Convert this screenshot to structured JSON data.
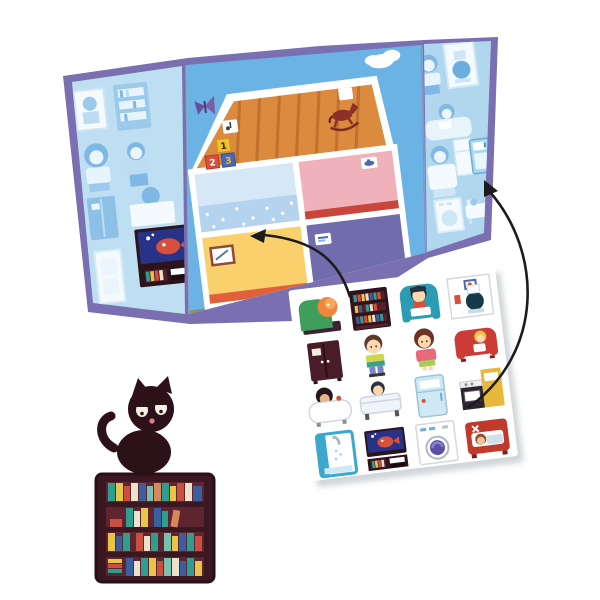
{
  "scene": {
    "description": "Product photo of a toy sticker play-set: open tri-fold house board, sticker sheet, loose cat and bookshelf stickers, two placement arrows",
    "background_color": "#ffffff"
  },
  "colors": {
    "board_border": "#7a6fb0",
    "left_flap_bg": "#bedef2",
    "center_bg": "#6cb3e5",
    "right_flap_bg": "#b0d7ee",
    "attic_floor": "#dc8a3e",
    "room_bathroom": "#d6e8f6",
    "room_bedroom_pink": "#f0b2ba",
    "room_living_yellow": "#f9d06b",
    "room_play_purple": "#716cab",
    "ground": "#8d9464",
    "sheet_bg": "#ffffff",
    "arrow": "#1c1c1c",
    "cat": "#2d1118",
    "bookshelf": "#3b1722"
  },
  "board": {
    "left_flap": {
      "silhouette_items": [
        "framed picture",
        "bookshelf",
        "girl",
        "boy",
        "wardrobe",
        "child at desk",
        "door"
      ],
      "placed_sticker": "tv-stand-with-fish-tank"
    },
    "center_panel": {
      "sky_items": [
        "cloud",
        "butterfly"
      ],
      "house": {
        "attic": {
          "items": [
            "sticker slot",
            "toy blocks",
            "rocking horse",
            "wall slot"
          ],
          "blocks": [
            {
              "label": "1",
              "color": "#f2c02e"
            },
            {
              "label": "2",
              "color": "#d8503c"
            },
            {
              "label": "3",
              "color": "#4a69b2"
            }
          ]
        },
        "rooms": [
          {
            "name": "bathroom",
            "wall_color": "#d6e8f6",
            "accent": "dotted wallpaper band"
          },
          {
            "name": "bedroom",
            "wall_color": "#f0b2ba",
            "accent": "red baseboard, sticker slot"
          },
          {
            "name": "living-room",
            "wall_color": "#f9d06b",
            "accent": "picture frame"
          },
          {
            "name": "play-room",
            "wall_color": "#716cab",
            "accent": "sticker slot"
          }
        ],
        "ground_color": "#8d9464"
      }
    },
    "right_flap": {
      "silhouette_items": [
        "boy",
        "toilet in frame",
        "child on sofa",
        "father",
        "refrigerator",
        "washing machine",
        "bed with child"
      ],
      "placed_sticker": "refrigerator"
    }
  },
  "sticker_sheet": {
    "rows": [
      [
        "armchair-with-cat",
        "bookshelf",
        "armchair-with-boy",
        "toilet-frame"
      ],
      [
        "wardrobe",
        "boy",
        "girl",
        "sofa-with-child"
      ],
      [
        "bathtub-with-child",
        "bed-with-boy",
        "refrigerator",
        "kitchen-stove"
      ],
      [
        "shower",
        "tv-stand-with-fish-tank",
        "washing-machine",
        "bed-with-sleeping-child"
      ]
    ]
  },
  "loose_stickers": {
    "cat": {
      "color": "#2d1118",
      "pose": "sitting cat with curled tail and sleepy eyes"
    },
    "bookshelf": {
      "color": "#3b1722",
      "shelves": 4
    }
  },
  "arrows": [
    {
      "from": "sticker-sheet",
      "to": "house-living-room"
    },
    {
      "from": "sticker-sheet",
      "to": "right-flap-refrigerator"
    }
  ]
}
